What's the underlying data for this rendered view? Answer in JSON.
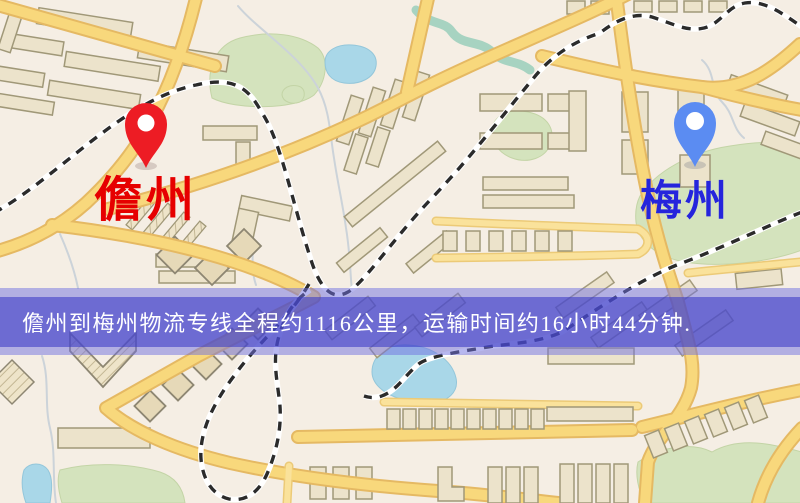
{
  "map": {
    "banner": {
      "text": "儋州到梅州物流专线全程约1116公里，运输时间约16小时44分钟.",
      "origin": "儋州",
      "destination": "梅州",
      "distance": "1116公里",
      "duration": "16小时44分钟"
    },
    "origin_marker": {
      "label": "儋州",
      "pin_color": "#ed1c24",
      "label_color": "#e60000"
    },
    "destination_marker": {
      "label": "梅州",
      "pin_color": "#5b8cf2",
      "label_color": "#2525dc"
    },
    "colors": {
      "background": "#f5eee4",
      "road_fill": "#f8d87c",
      "road_casing": "#e5b963",
      "park": "#d4e3bd",
      "water": "#a9d7e8",
      "railway": "#2b2b2b",
      "banner_light": "rgba(112,112,224,0.50)",
      "banner_dark": "rgba(58,58,198,0.58)"
    }
  }
}
